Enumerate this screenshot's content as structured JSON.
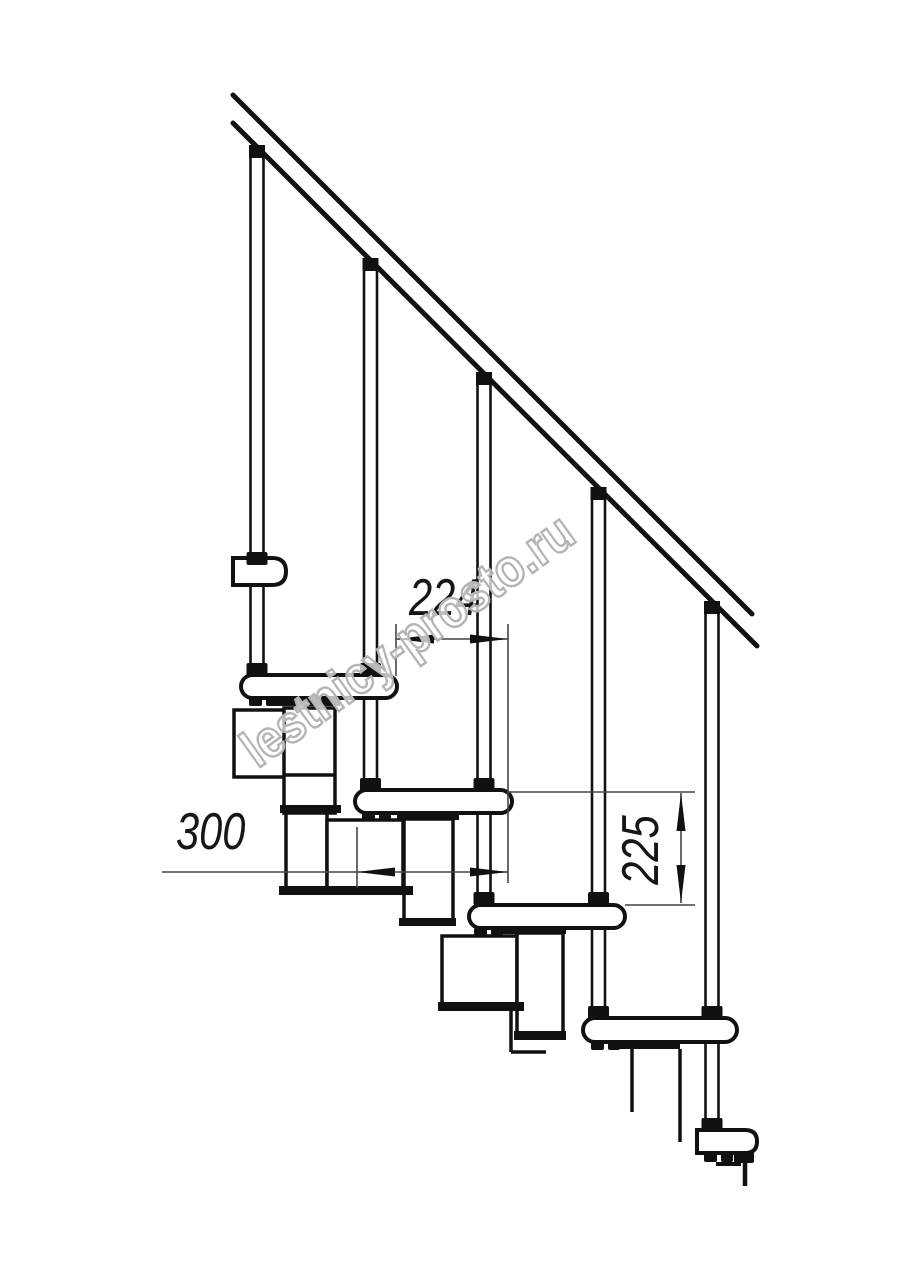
{
  "document": {
    "type": "technical-drawing",
    "subject": "modular staircase side elevation",
    "background_color": "#ffffff",
    "line_color": "#111111",
    "dim_line_color": "#444444",
    "watermark_color": "#b4b4b4"
  },
  "dimensions": {
    "run": {
      "value": "224",
      "orientation": "horizontal"
    },
    "width": {
      "value": "300",
      "orientation": "horizontal"
    },
    "rise": {
      "value": "225",
      "orientation": "vertical"
    }
  },
  "watermark": {
    "text": "lestnicy-prosto.ru"
  }
}
